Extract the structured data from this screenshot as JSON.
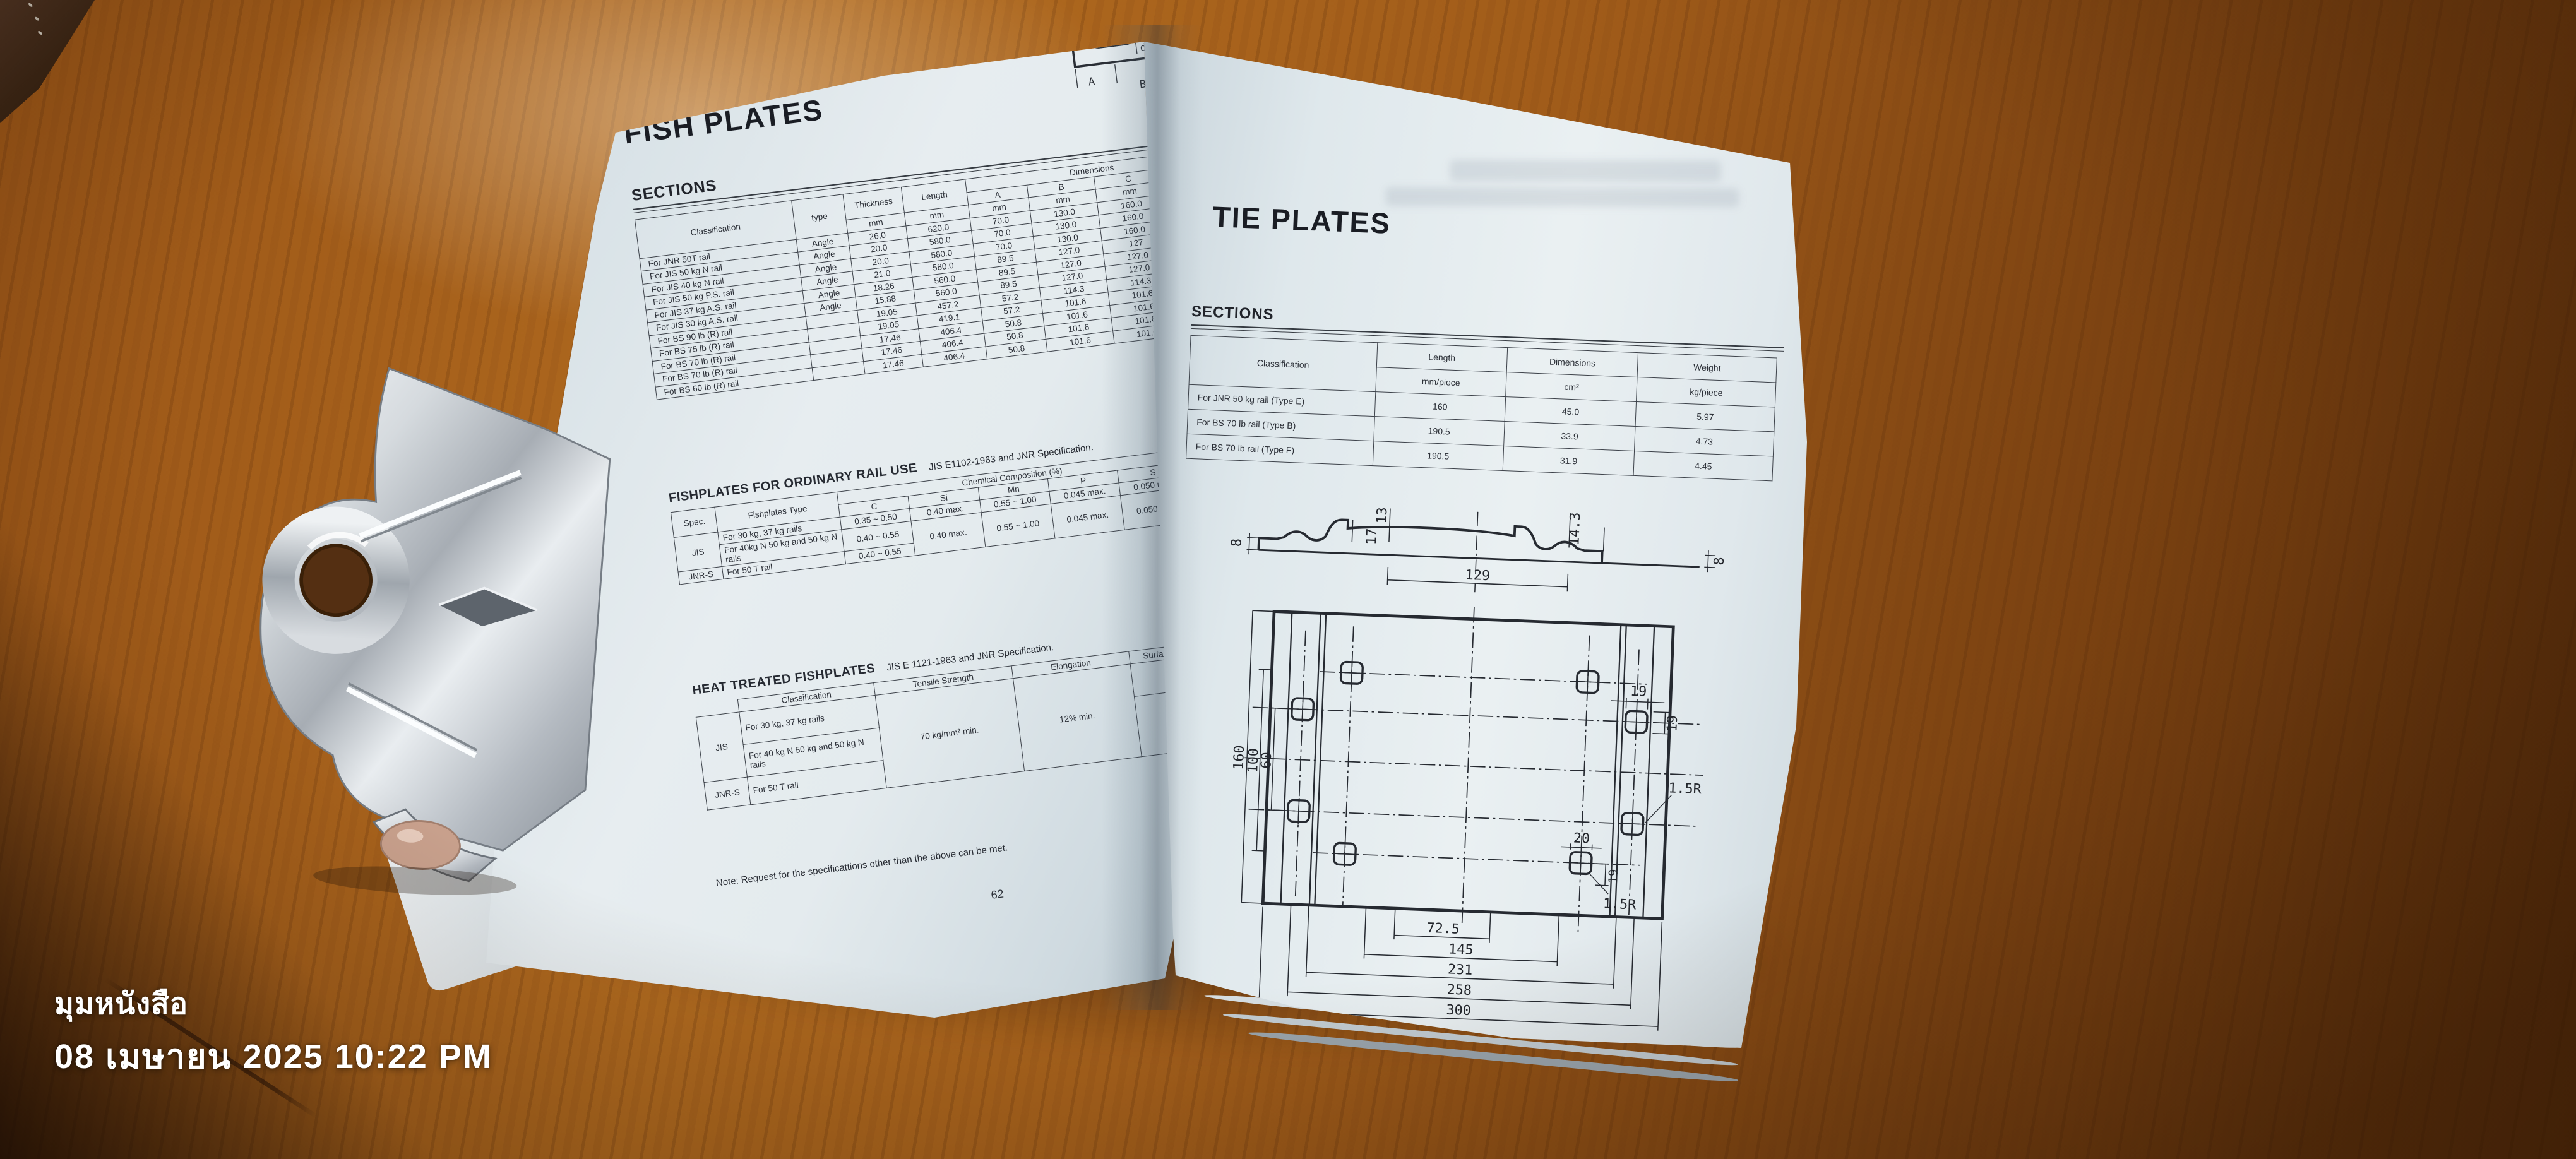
{
  "overlay": {
    "app_label": "มุมหนังสือ",
    "datetime": "08 เมษายน 2025 10:22 PM"
  },
  "left_page": {
    "title": "FISH PLATES",
    "page_number": "62",
    "note": "Note: Request for the specificattions other than the above can be met.",
    "diagram": {
      "label_a": "A",
      "label_b": "B",
      "label_d": "d"
    },
    "sections": {
      "heading": "SECTIONS",
      "headers": {
        "classification": "Classification",
        "type": "type",
        "thickness": "Thickness",
        "length": "Length",
        "dimensions": "Dimensions",
        "a": "A",
        "b": "B",
        "c": "C",
        "d": "d",
        "mm": "mm"
      },
      "rows": [
        {
          "classification": "For JNR 50T rail",
          "type": "Angle",
          "thickness": "26.0",
          "length": "620.0",
          "a": "70.0",
          "b": "130.0",
          "c": "160.0",
          "d": "24.00"
        },
        {
          "classification": "For JIS 50 kg N rail",
          "type": "Angle",
          "thickness": "20.0",
          "length": "580.0",
          "a": "70.0",
          "b": "130.0",
          "c": "160.0",
          "d": "24.00"
        },
        {
          "classification": "For JIS 40 kg N rail",
          "type": "Angle",
          "thickness": "20.0",
          "length": "580.0",
          "a": "70.0",
          "b": "130.0",
          "c": "160.0",
          "d": "24.00"
        },
        {
          "classification": "For JIS 50 kg P.S. rail",
          "type": "Angle",
          "thickness": "21.0",
          "length": "580.0",
          "a": "89.5",
          "b": "127.0",
          "c": "127",
          "d": "28.00"
        },
        {
          "classification": "For JIS 37 kg A.S. rail",
          "type": "Angle",
          "thickness": "18.26",
          "length": "560.0",
          "a": "89.5",
          "b": "127.0",
          "c": "127.0",
          "d": "22.00"
        },
        {
          "classification": "For JIS 30 kg A.S. rail",
          "type": "Angle",
          "thickness": "15.88",
          "length": "560.0",
          "a": "89.5",
          "b": "127.0",
          "c": "127.0",
          "d": "22.00"
        },
        {
          "classification": "For BS 90 lb (R) rail",
          "type": "",
          "thickness": "19.05",
          "length": "457.2",
          "a": "57.2",
          "b": "114.3",
          "c": "114.3",
          "d": "26.99"
        },
        {
          "classification": "For BS 75 lb (R) rail",
          "type": "",
          "thickness": "19.05",
          "length": "419.1",
          "a": "57.2",
          "b": "101.6",
          "c": "101.6",
          "d": "26.99"
        },
        {
          "classification": "For BS 70 lb (R) rail",
          "type": "",
          "thickness": "17.46",
          "length": "406.4",
          "a": "50.8",
          "b": "101.6",
          "c": "101.6",
          "d": "22.22"
        },
        {
          "classification": "For BS 70 lb (R) rail",
          "type": "",
          "thickness": "17.46",
          "length": "406.4",
          "a": "50.8",
          "b": "101.6",
          "c": "101.6",
          "d": "22.23"
        },
        {
          "classification": "For BS 60 lb (R) rail",
          "type": "",
          "thickness": "17.46",
          "length": "406.4",
          "a": "50.8",
          "b": "101.6",
          "c": "101.6",
          "d": "23.81"
        }
      ]
    },
    "ordinary": {
      "heading": "FISHPLATES FOR ORDINARY RAIL USE",
      "spec_note": "JIS E1102-1963 and JNR Specification.",
      "headers": {
        "spec": "Spec.",
        "type": "Fishplates Type",
        "chem": "Chemical Composition (%)",
        "c": "C",
        "si": "Si",
        "mn": "Mn",
        "p": "P",
        "s": "S",
        "tensile": "Tensile Strength"
      },
      "rows": [
        {
          "spec": "JIS",
          "type": "For 30 kg, 37 kg rails",
          "c": "0.35 ~ 0.50",
          "si": "0.40 max.",
          "mn": "0.55 ~ 1.00",
          "p": "0.045 max.",
          "s": "0.050 max.",
          "tensile": "55 kg/mm² min."
        },
        {
          "type": "For 40kg N 50 kg and 50 kg N rails",
          "c": "0.40 ~ 0.55",
          "si": "0.40 max.",
          "mn": "0.55 ~ 1.00",
          "p": "0.045 max.",
          "s": "0.050 max.",
          "tensile": "58 kg/mm² min."
        },
        {
          "spec": "JNR-S",
          "type": "For 50 T rail",
          "c": "0.40 ~ 0.55",
          "tensile": "58 kg/mm² min."
        }
      ]
    },
    "heat": {
      "heading": "HEAT TREATED FISHPLATES",
      "spec_note": "JIS E 1121-1963 and JNR Specification.",
      "headers": {
        "classification": "Classification",
        "tensile": "Tensile Strength",
        "elongation": "Elongation",
        "hardness": "Surface Hardness (Brinnel)"
      },
      "rows": [
        {
          "spec": "JIS",
          "classification": "For 30 kg, 37 kg rails",
          "tensile": "70 kg/mm² min.",
          "elongation": "12% min.",
          "hardness": "262 ~ 331"
        },
        {
          "classification": "For 40 kg N 50 kg and 50 kg N rails",
          "hardness": "262 ~ 331"
        },
        {
          "spec": "JNR-S",
          "classification": "For 50 T rail"
        }
      ]
    }
  },
  "right_page": {
    "title": "TIE PLATES",
    "page_number": "63",
    "sections": {
      "heading": "SECTIONS",
      "headers": {
        "classification": "Classification",
        "length": "Length",
        "length_unit": "mm/piece",
        "dimensions": "Dimensions",
        "dimensions_unit": "cm²",
        "weight": "Weight",
        "weight_unit": "kg/piece"
      },
      "rows": [
        {
          "classification": "For JNR 50 kg rail (Type E)",
          "length": "160",
          "dimensions": "45.0",
          "weight": "5.97"
        },
        {
          "classification": "For BS 70 lb rail (Type B)",
          "length": "190.5",
          "dimensions": "33.9",
          "weight": "4.73"
        },
        {
          "classification": "For BS 70 lb rail (Type F)",
          "length": "190.5",
          "dimensions": "31.9",
          "weight": "4.45"
        }
      ]
    },
    "drawing": {
      "profile_left_8": "8",
      "profile_13": "13",
      "profile_17": "17",
      "profile_14_3": "14.3",
      "profile_129": "129",
      "profile_right_8": "8",
      "width_160": "160",
      "width_100": "100",
      "width_60": "60",
      "hole_19_top": "19",
      "hole_19_side": "19",
      "hole_20": "20",
      "hole_19_inner": "19",
      "radius_1": "1.5R",
      "radius_2": "1.5R",
      "bottom_72_5": "72.5",
      "bottom_145": "145",
      "bottom_231": "231",
      "bottom_258": "258",
      "bottom_300": "300"
    }
  }
}
